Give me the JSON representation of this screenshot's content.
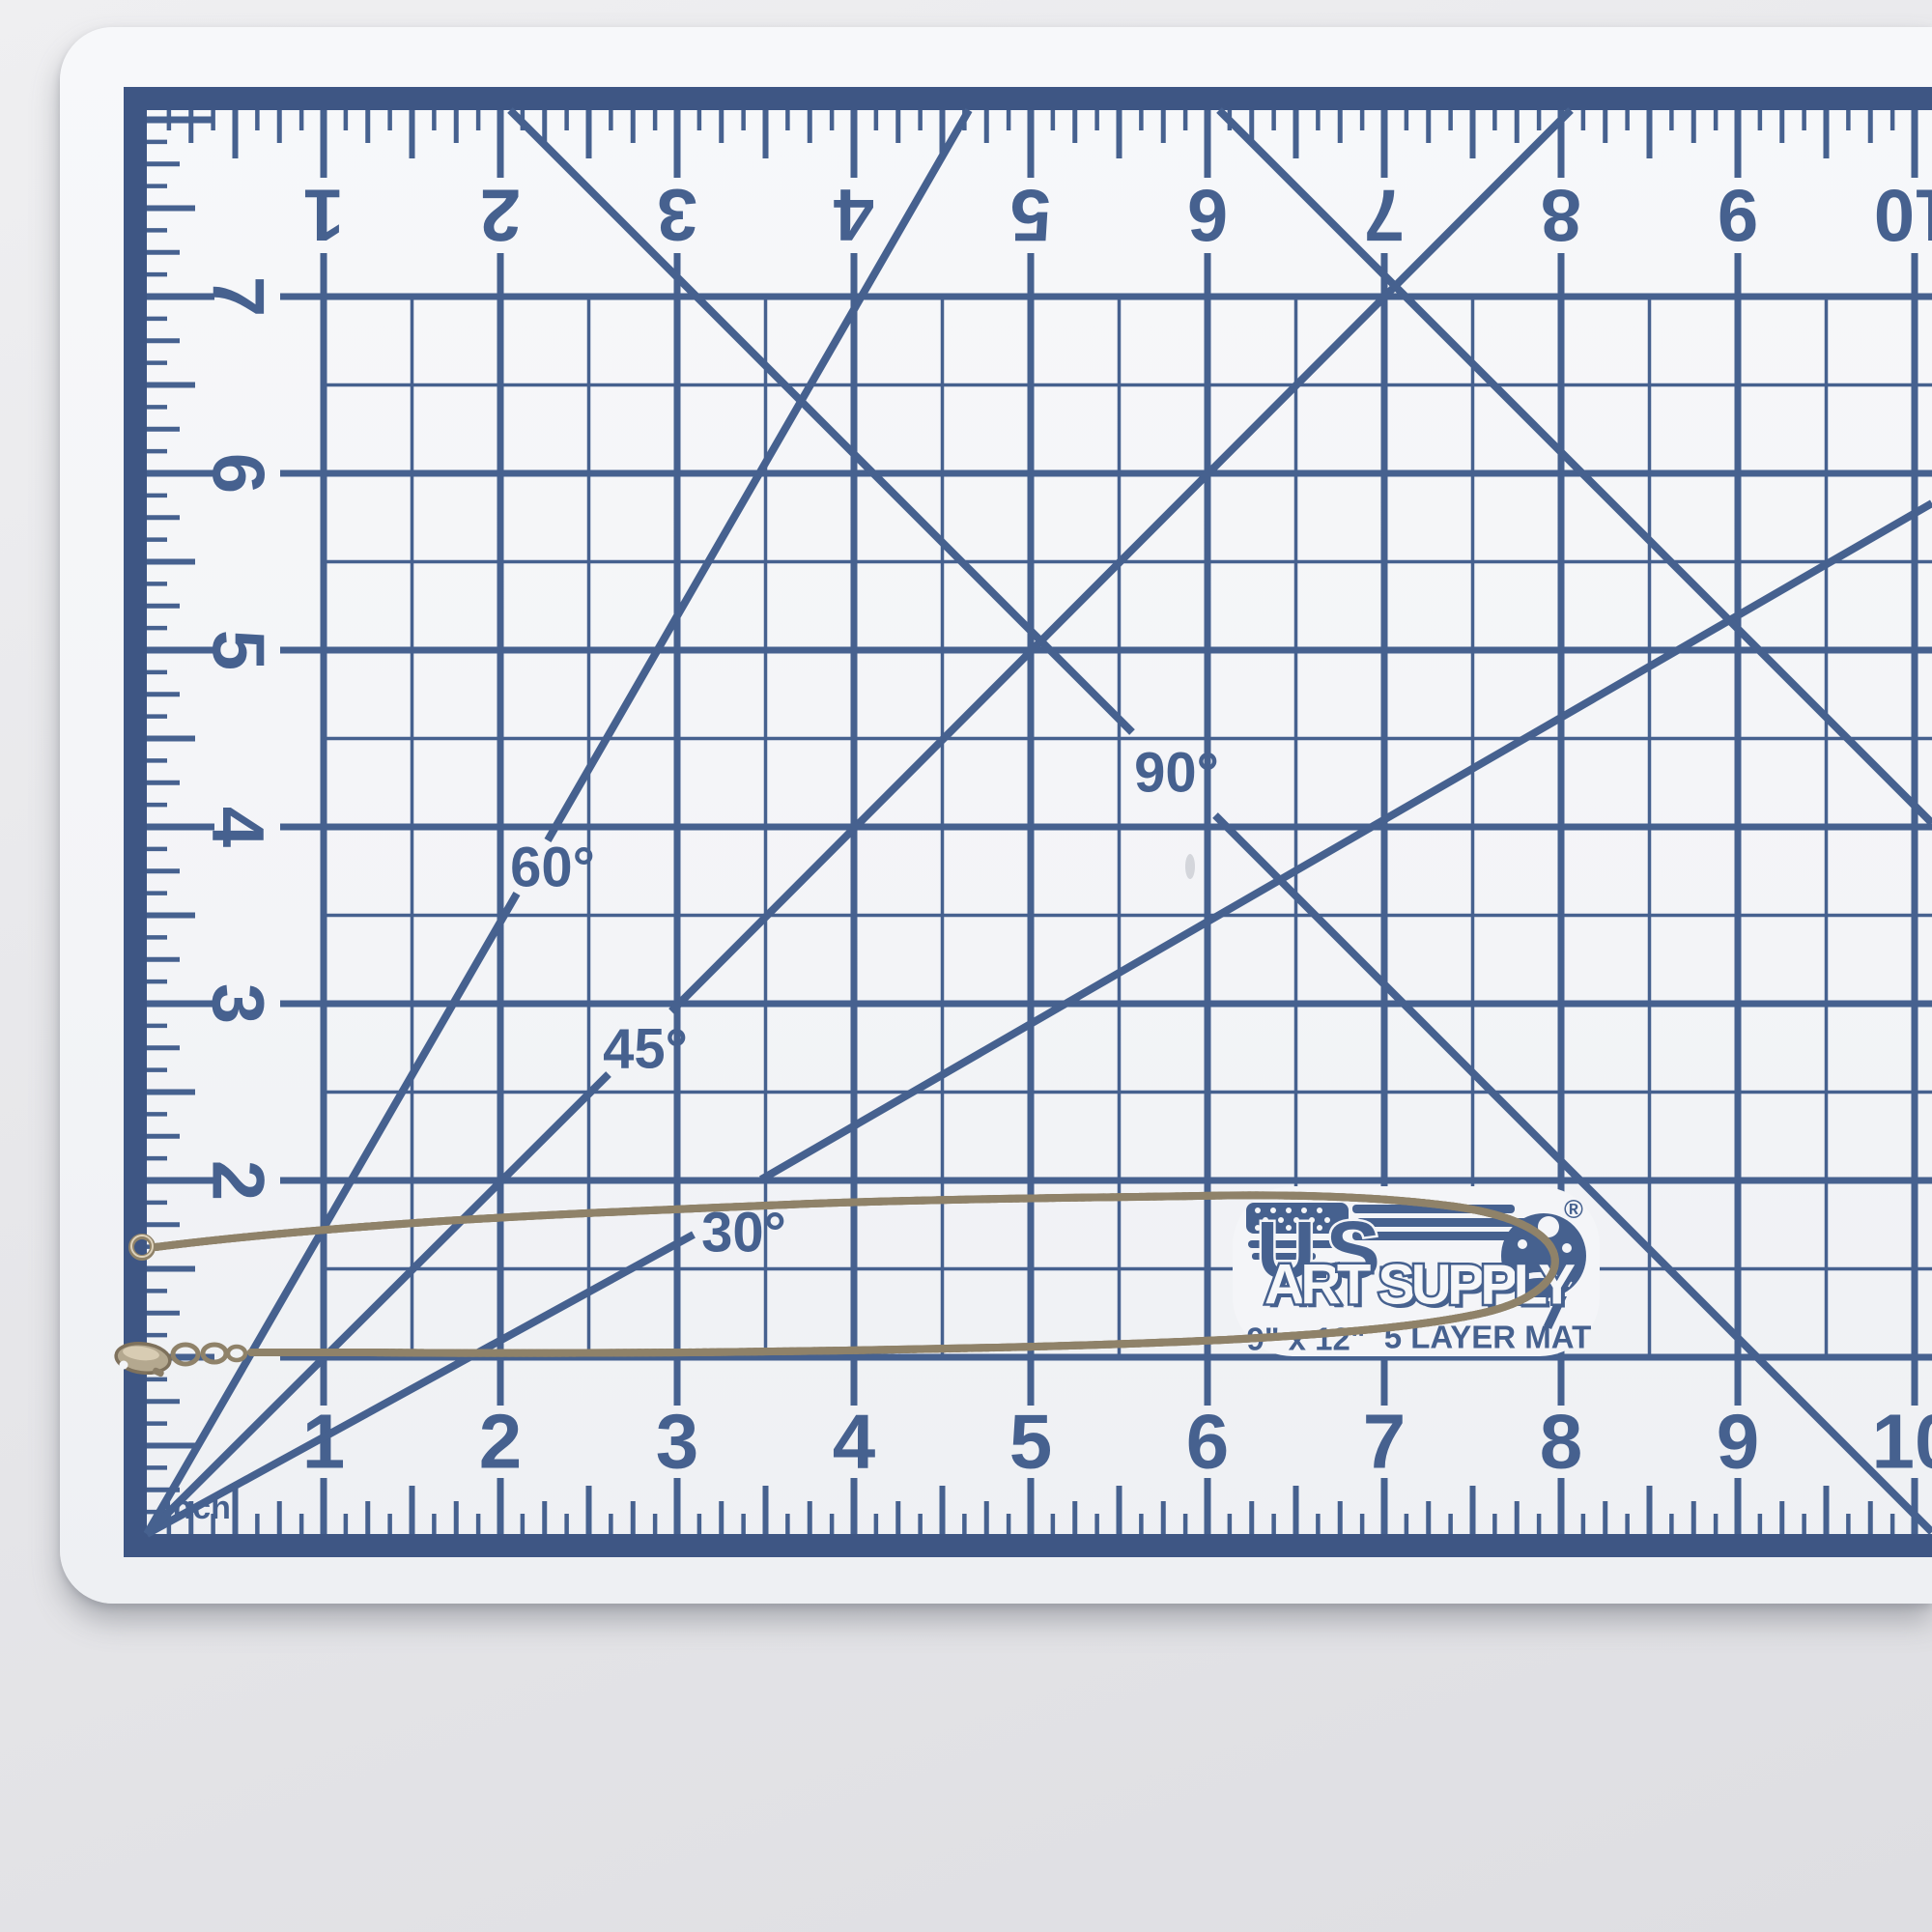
{
  "scene": {
    "background_color": "#e7e7ea"
  },
  "mat": {
    "surface_color": "#f4f5f8",
    "print_color": "#46618f",
    "border_color": "#3e5684",
    "top_scale": [
      "1",
      "2",
      "3",
      "4",
      "5",
      "6",
      "7",
      "8",
      "9",
      "10"
    ],
    "bottom_scale": [
      "1",
      "2",
      "3",
      "4",
      "5",
      "6",
      "7",
      "8",
      "9",
      "10"
    ],
    "left_scale": [
      "7",
      "6",
      "5",
      "4",
      "3",
      "2"
    ],
    "angle_labels": [
      "30°",
      "45°",
      "60°",
      "90°"
    ],
    "unit_label": "inch",
    "logo": {
      "brand_top": "U.S.",
      "brand_bottom": "ART SUPPLY",
      "registered": "®",
      "size": "9\" x 12\"",
      "layers": "5 LAYER MAT"
    }
  },
  "chain": {
    "color": "#b4a88f",
    "outline": "#8f8269",
    "highlight": "#ded2ba",
    "glint": "#efe6d2"
  }
}
